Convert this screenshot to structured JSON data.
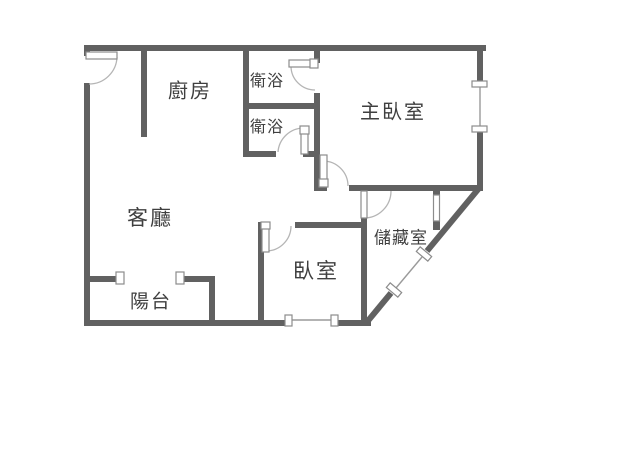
{
  "floorplan": {
    "type": "apartment-floor-plan",
    "rooms": {
      "kitchen": {
        "label": "廚房"
      },
      "bath_upper": {
        "label": "衛浴"
      },
      "bath_lower": {
        "label": "衛浴"
      },
      "master_bedroom": {
        "label": "主臥室"
      },
      "living_room": {
        "label": "客廳"
      },
      "bedroom": {
        "label": "臥室"
      },
      "storage": {
        "label": "儲藏室"
      },
      "balcony": {
        "label": "陽台"
      }
    },
    "colors": {
      "wall": "#616161",
      "text": "#3f3f3f",
      "arc": "#b5b5b5",
      "frame": "#8c8c8c",
      "glass": "#9a9a9a",
      "bg": "#ffffff"
    }
  }
}
